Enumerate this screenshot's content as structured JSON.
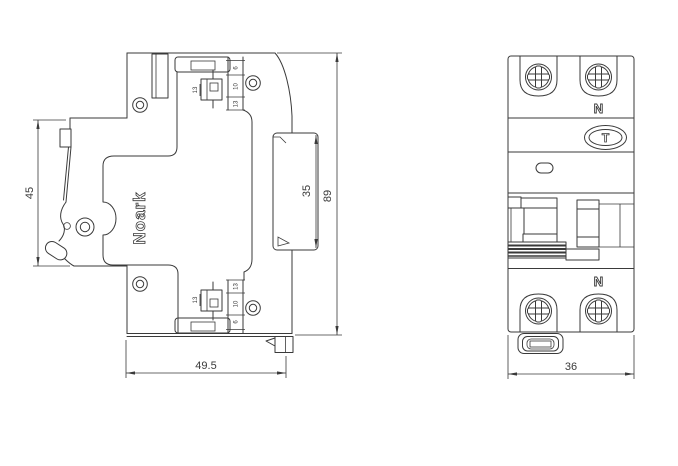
{
  "colors": {
    "line": "#3a3a3a",
    "background": "#ffffff"
  },
  "drawing": {
    "brand": "Noark",
    "side_view": {
      "dim_front_height": "45",
      "dim_width": "49.5",
      "dim_din_recess_height": "35",
      "dim_total_height": "89",
      "terminal_callouts_top": [
        "6",
        "10",
        "13"
      ],
      "terminal_callouts_bottom": [
        "13",
        "10",
        "6"
      ],
      "clamp_callout_top": "13",
      "clamp_callout_bottom": "13"
    },
    "front_view": {
      "dim_width": "36",
      "neutral_label_top": "N",
      "neutral_label_bottom": "N",
      "test_button_label": "T"
    }
  }
}
